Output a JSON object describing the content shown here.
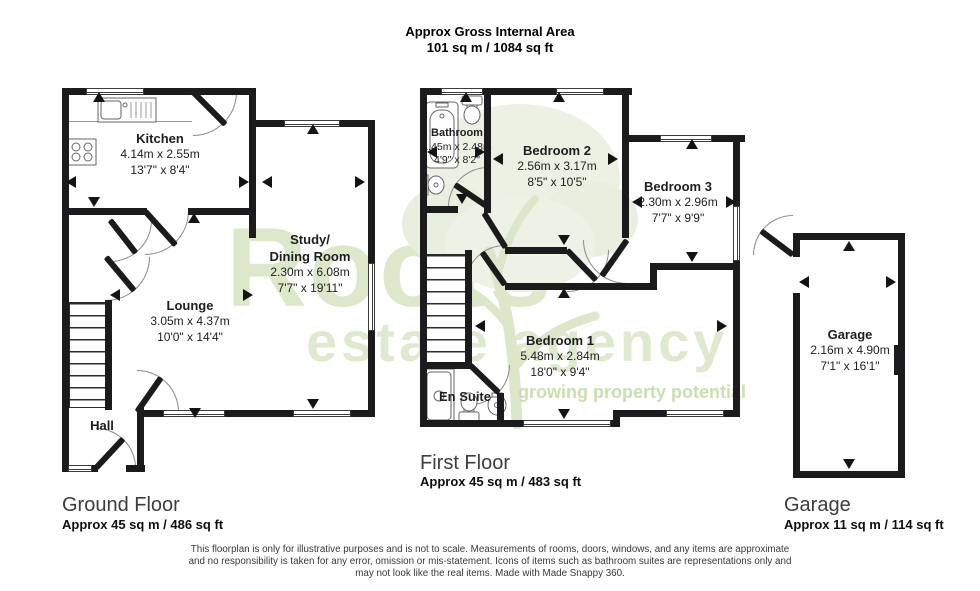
{
  "header": {
    "line1": "Approx Gross Internal Area",
    "line2": "101 sq m / 1084 sq ft"
  },
  "watermark": {
    "brand": "Roots",
    "brand_sub": "estate agency",
    "tagline": "growing property potential"
  },
  "ground_floor": {
    "title": "Ground Floor",
    "area": "Approx 45 sq m / 486 sq ft",
    "rooms": {
      "kitchen": {
        "name": "Kitchen",
        "metric": "4.14m x 2.55m",
        "imperial": "13'7\" x 8'4\""
      },
      "study": {
        "name": "Study/",
        "name2": "Dining Room",
        "metric": "2.30m x 6.08m",
        "imperial": "7'7\" x 19'11\""
      },
      "lounge": {
        "name": "Lounge",
        "metric": "3.05m x 4.37m",
        "imperial": "10'0\" x 14'4\""
      },
      "hall": {
        "name": "Hall"
      }
    }
  },
  "first_floor": {
    "title": "First Floor",
    "area": "Approx 45 sq m / 483 sq ft",
    "rooms": {
      "bathroom": {
        "name": "Bathroom",
        "metric": "1.45m x 2.48m",
        "imperial": "4'9\" x 8'2\""
      },
      "bedroom2": {
        "name": "Bedroom 2",
        "metric": "2.56m x 3.17m",
        "imperial": "8'5\" x 10'5\""
      },
      "bedroom3": {
        "name": "Bedroom 3",
        "metric": "2.30m x 2.96m",
        "imperial": "7'7\" x 9'9\""
      },
      "bedroom1": {
        "name": "Bedroom 1",
        "metric": "5.48m x 2.84m",
        "imperial": "18'0\" x 9'4\""
      },
      "ensuite": {
        "name": "En Suite"
      }
    }
  },
  "garage_floor": {
    "title": "Garage",
    "area": "Approx 11 sq m / 114 sq ft",
    "room": {
      "name": "Garage",
      "metric": "2.16m x 4.90m",
      "imperial": "7'1\" x 16'1\""
    }
  },
  "disclaimer": {
    "line1": "This floorplan is only for illustrative purposes and is not to scale. Measurements of rooms, doors, windows, and any items are approximate",
    "line2": "and no responsibility is taken for any error, omission or mis-statement. Icons of items such as bathroom suites are representations only and",
    "line3": "may not look like the real items. Made with Made Snappy 360."
  }
}
